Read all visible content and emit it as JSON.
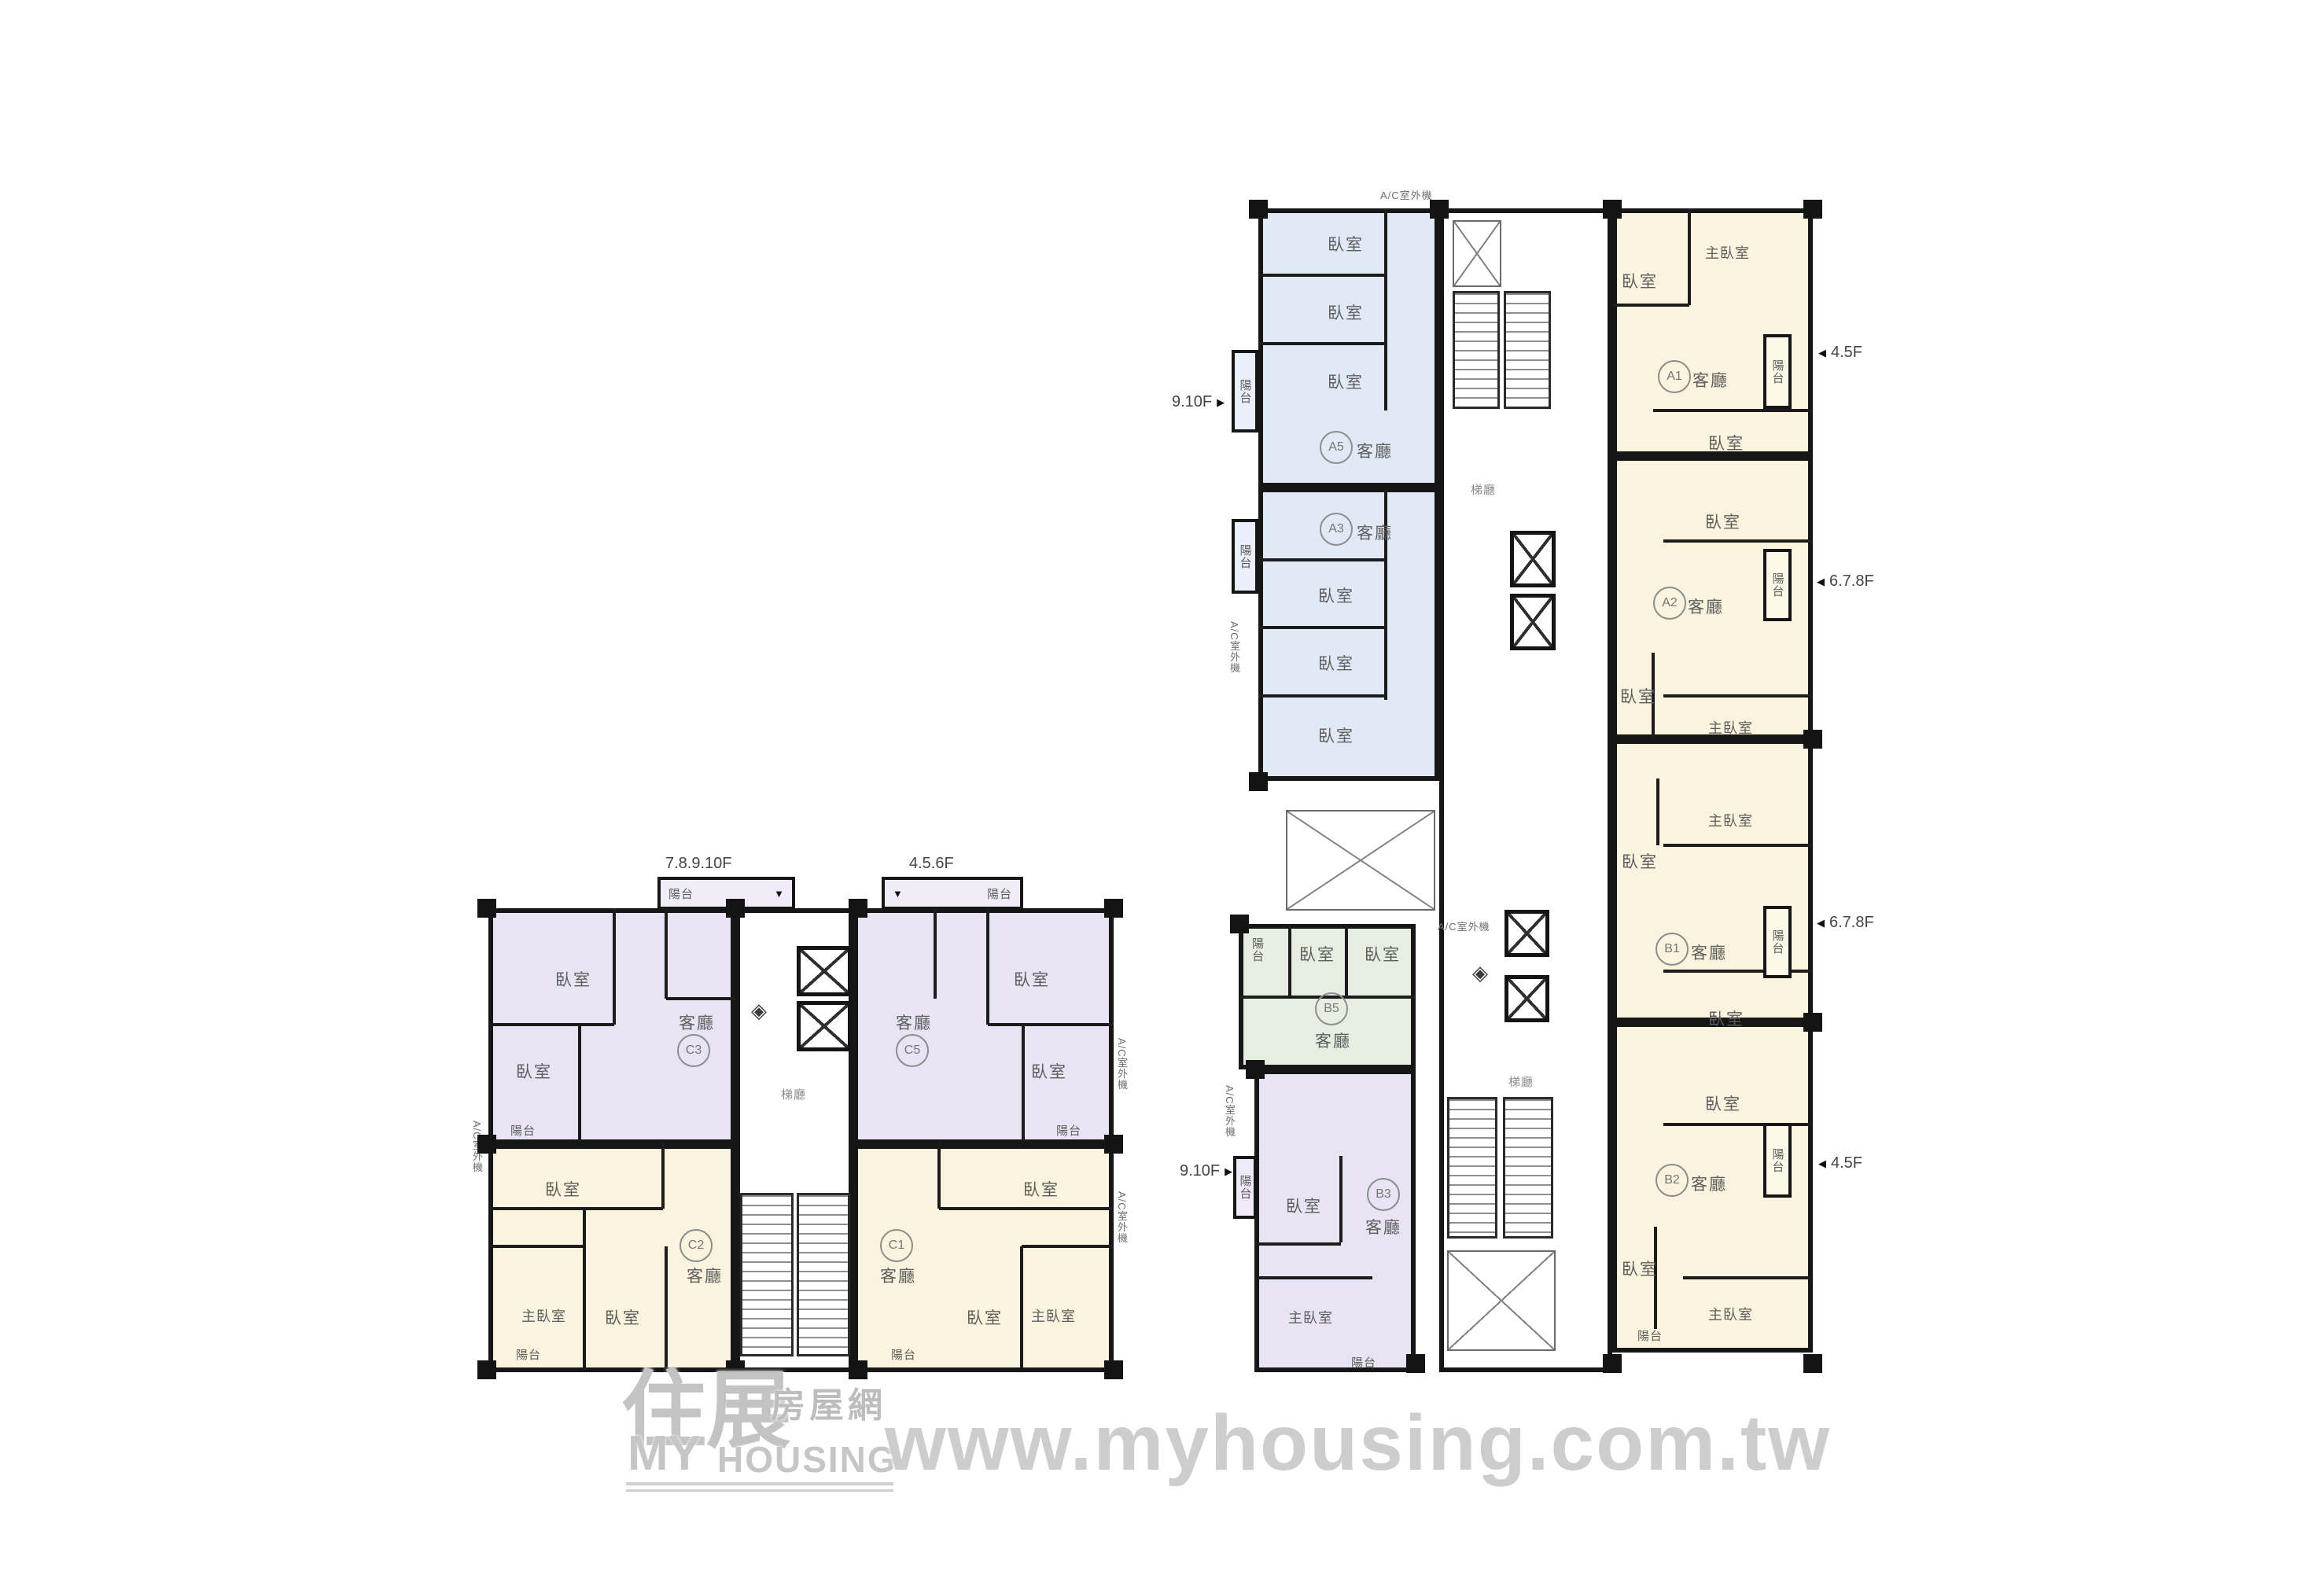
{
  "branding": {
    "watermark": "www.myhousing.com.tw",
    "logo_script": "住展",
    "logo_cn": "房屋網",
    "logo_my": "MY",
    "logo_housing": "HOUSING"
  },
  "labels": {
    "bedroom": "臥室",
    "master_bedroom": "主臥室",
    "living_room": "客廳",
    "balcony": "陽台",
    "lift_hall": "梯廳",
    "ac_unit": "A/C室外機",
    "arrow_down": "▼",
    "arrow_left": "◀",
    "arrow_right": "▶",
    "diamond": "◈"
  },
  "left_building": {
    "floor_label_left": "7.8.9.10F",
    "floor_label_right": "4.5.6F",
    "units": {
      "top_left": "C3",
      "top_right": "C5",
      "bottom_left": "C2",
      "bottom_right": "C1"
    }
  },
  "right_building": {
    "floor_label_blue": "9.10F",
    "floor_label_purple": "9.10F",
    "floor_label_a1": "4.5F",
    "floor_label_a2": "6.7.8F",
    "floor_label_b1": "6.7.8F",
    "floor_label_b2": "4.5F",
    "units": {
      "blue_top": "A5",
      "blue_bottom": "A3",
      "cream_1": "A1",
      "cream_2": "A2",
      "cream_3": "B1",
      "cream_4": "B2",
      "green": "B5",
      "purple": "B3"
    }
  },
  "colors": {
    "unit_purple": "#e8e4f4",
    "unit_cream": "#faf3dd",
    "unit_blue": "#e1e9f6",
    "unit_green": "#e5eee1",
    "wall": "#161616",
    "watermark_gray": "#cdcdcd"
  }
}
